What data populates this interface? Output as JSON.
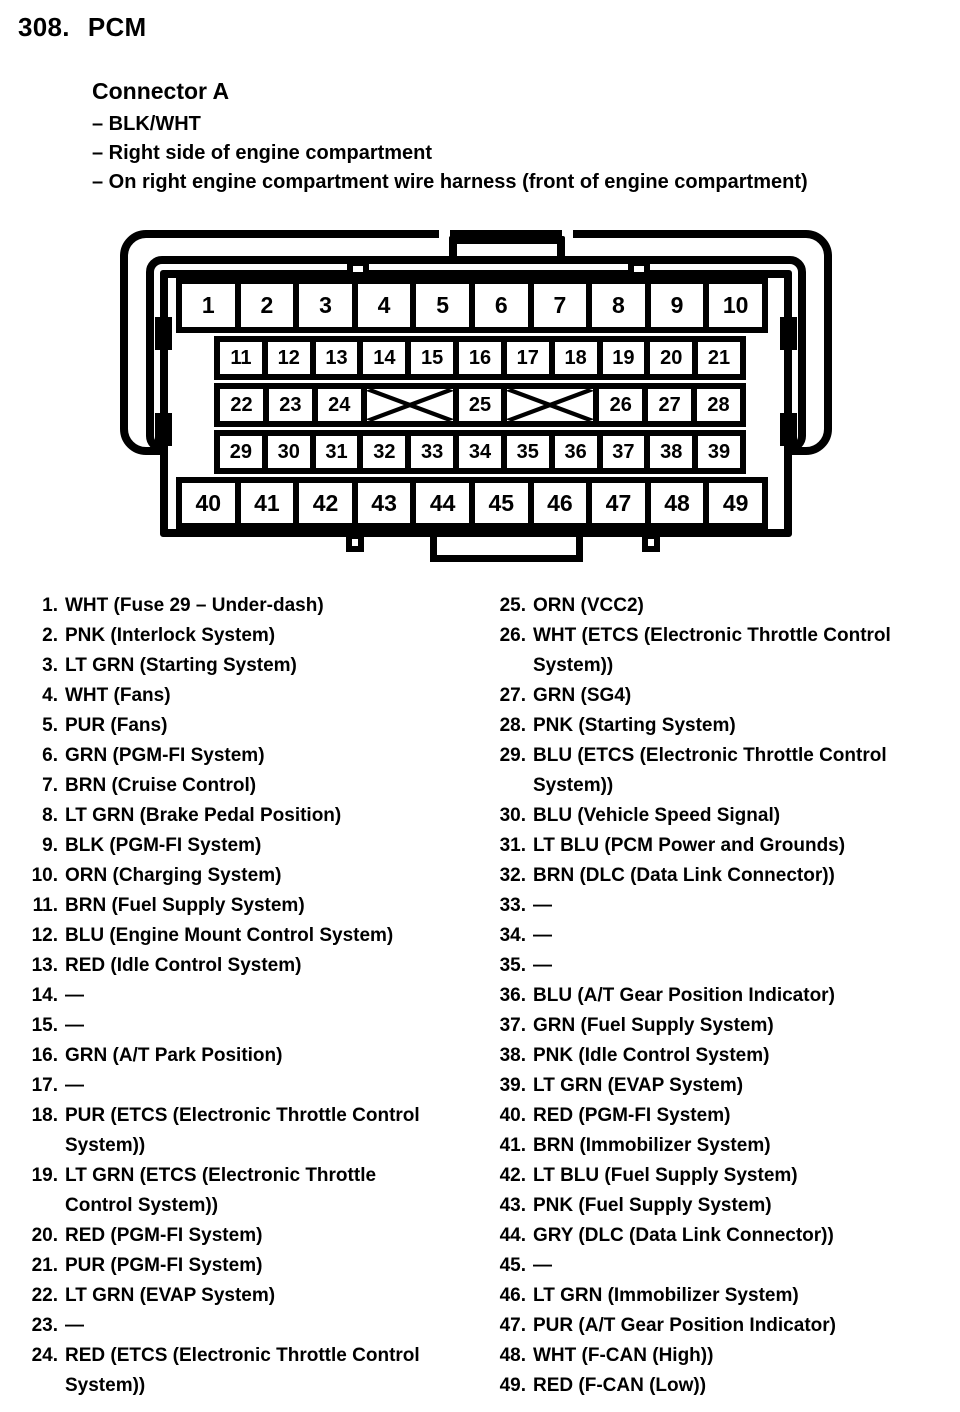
{
  "page": {
    "section_number": "308.",
    "title": "PCM"
  },
  "connector": {
    "heading": "Connector A",
    "bullets": [
      "– BLK/WHT",
      "– Right side of engine compartment",
      "– On right engine compartment wire harness (front of engine compartment)"
    ],
    "diagram": {
      "rows": [
        {
          "cells": [
            "1",
            "2",
            "3",
            "4",
            "5",
            "6",
            "7",
            "8",
            "9",
            "10"
          ]
        },
        {
          "cells": [
            "11",
            "12",
            "13",
            "14",
            "15",
            "16",
            "17",
            "18",
            "19",
            "20",
            "21"
          ]
        },
        {
          "cells": [
            "22",
            "23",
            "24",
            {
              "crossed": true,
              "span": 2
            },
            "25",
            {
              "crossed": true,
              "span": 2
            },
            "26",
            "27",
            "28"
          ]
        },
        {
          "cells": [
            "29",
            "30",
            "31",
            "32",
            "33",
            "34",
            "35",
            "36",
            "37",
            "38",
            "39"
          ]
        },
        {
          "cells": [
            "40",
            "41",
            "42",
            "43",
            "44",
            "45",
            "46",
            "47",
            "48",
            "49"
          ]
        }
      ]
    }
  },
  "pins_left": [
    {
      "num": "1.",
      "label": "WHT (Fuse 29 – Under-dash)"
    },
    {
      "num": "2.",
      "label": "PNK (Interlock System)"
    },
    {
      "num": "3.",
      "label": "LT GRN (Starting System)"
    },
    {
      "num": "4.",
      "label": "WHT (Fans)"
    },
    {
      "num": "5.",
      "label": "PUR (Fans)"
    },
    {
      "num": "6.",
      "label": "GRN (PGM-FI System)"
    },
    {
      "num": "7.",
      "label": "BRN (Cruise Control)"
    },
    {
      "num": "8.",
      "label": "LT GRN (Brake Pedal Position)"
    },
    {
      "num": "9.",
      "label": "BLK (PGM-FI System)"
    },
    {
      "num": "10.",
      "label": "ORN (Charging System)"
    },
    {
      "num": "11.",
      "label": "BRN (Fuel Supply System)"
    },
    {
      "num": "12.",
      "label": "BLU (Engine Mount Control System)"
    },
    {
      "num": "13.",
      "label": "RED (Idle Control System)"
    },
    {
      "num": "14.",
      "label": "—"
    },
    {
      "num": "15.",
      "label": "—"
    },
    {
      "num": "16.",
      "label": "GRN (A/T Park Position)"
    },
    {
      "num": "17.",
      "label": "—"
    },
    {
      "num": "18.",
      "label": "PUR (ETCS (Electronic Throttle Control\nSystem))"
    },
    {
      "num": "19.",
      "label": "LT GRN (ETCS (Electronic Throttle\nControl System))"
    },
    {
      "num": "20.",
      "label": "RED (PGM-FI System)"
    },
    {
      "num": "21.",
      "label": "PUR (PGM-FI System)"
    },
    {
      "num": "22.",
      "label": "LT GRN (EVAP System)"
    },
    {
      "num": "23.",
      "label": "—"
    },
    {
      "num": "24.",
      "label": "RED (ETCS (Electronic Throttle Control\nSystem))"
    }
  ],
  "pins_right": [
    {
      "num": "25.",
      "label": "ORN (VCC2)"
    },
    {
      "num": "26.",
      "label": "WHT (ETCS (Electronic Throttle Control\nSystem))"
    },
    {
      "num": "27.",
      "label": "GRN (SG4)"
    },
    {
      "num": "28.",
      "label": "PNK (Starting System)"
    },
    {
      "num": "29.",
      "label": "BLU (ETCS (Electronic Throttle Control\nSystem))"
    },
    {
      "num": "30.",
      "label": "BLU (Vehicle Speed Signal)"
    },
    {
      "num": "31.",
      "label": "LT BLU (PCM Power and Grounds)"
    },
    {
      "num": "32.",
      "label": "BRN (DLC (Data Link Connector))"
    },
    {
      "num": "33.",
      "label": "—"
    },
    {
      "num": "34.",
      "label": "—"
    },
    {
      "num": "35.",
      "label": "—"
    },
    {
      "num": "36.",
      "label": "BLU (A/T Gear Position Indicator)"
    },
    {
      "num": "37.",
      "label": "GRN (Fuel Supply System)"
    },
    {
      "num": "38.",
      "label": "PNK (Idle Control System)"
    },
    {
      "num": "39.",
      "label": "LT GRN (EVAP System)"
    },
    {
      "num": "40.",
      "label": "RED (PGM-FI System)"
    },
    {
      "num": "41.",
      "label": "BRN (Immobilizer System)"
    },
    {
      "num": "42.",
      "label": "LT BLU (Fuel Supply System)"
    },
    {
      "num": "43.",
      "label": "PNK (Fuel Supply System)"
    },
    {
      "num": "44.",
      "label": "GRY (DLC (Data Link Connector))"
    },
    {
      "num": "45.",
      "label": "—"
    },
    {
      "num": "46.",
      "label": "LT GRN (Immobilizer System)"
    },
    {
      "num": "47.",
      "label": "PUR (A/T Gear Position Indicator)"
    },
    {
      "num": "48.",
      "label": "WHT (F-CAN (High))"
    },
    {
      "num": "49.",
      "label": "RED (F-CAN (Low))"
    }
  ],
  "colors": {
    "ink": "#000000",
    "paper": "#ffffff"
  }
}
